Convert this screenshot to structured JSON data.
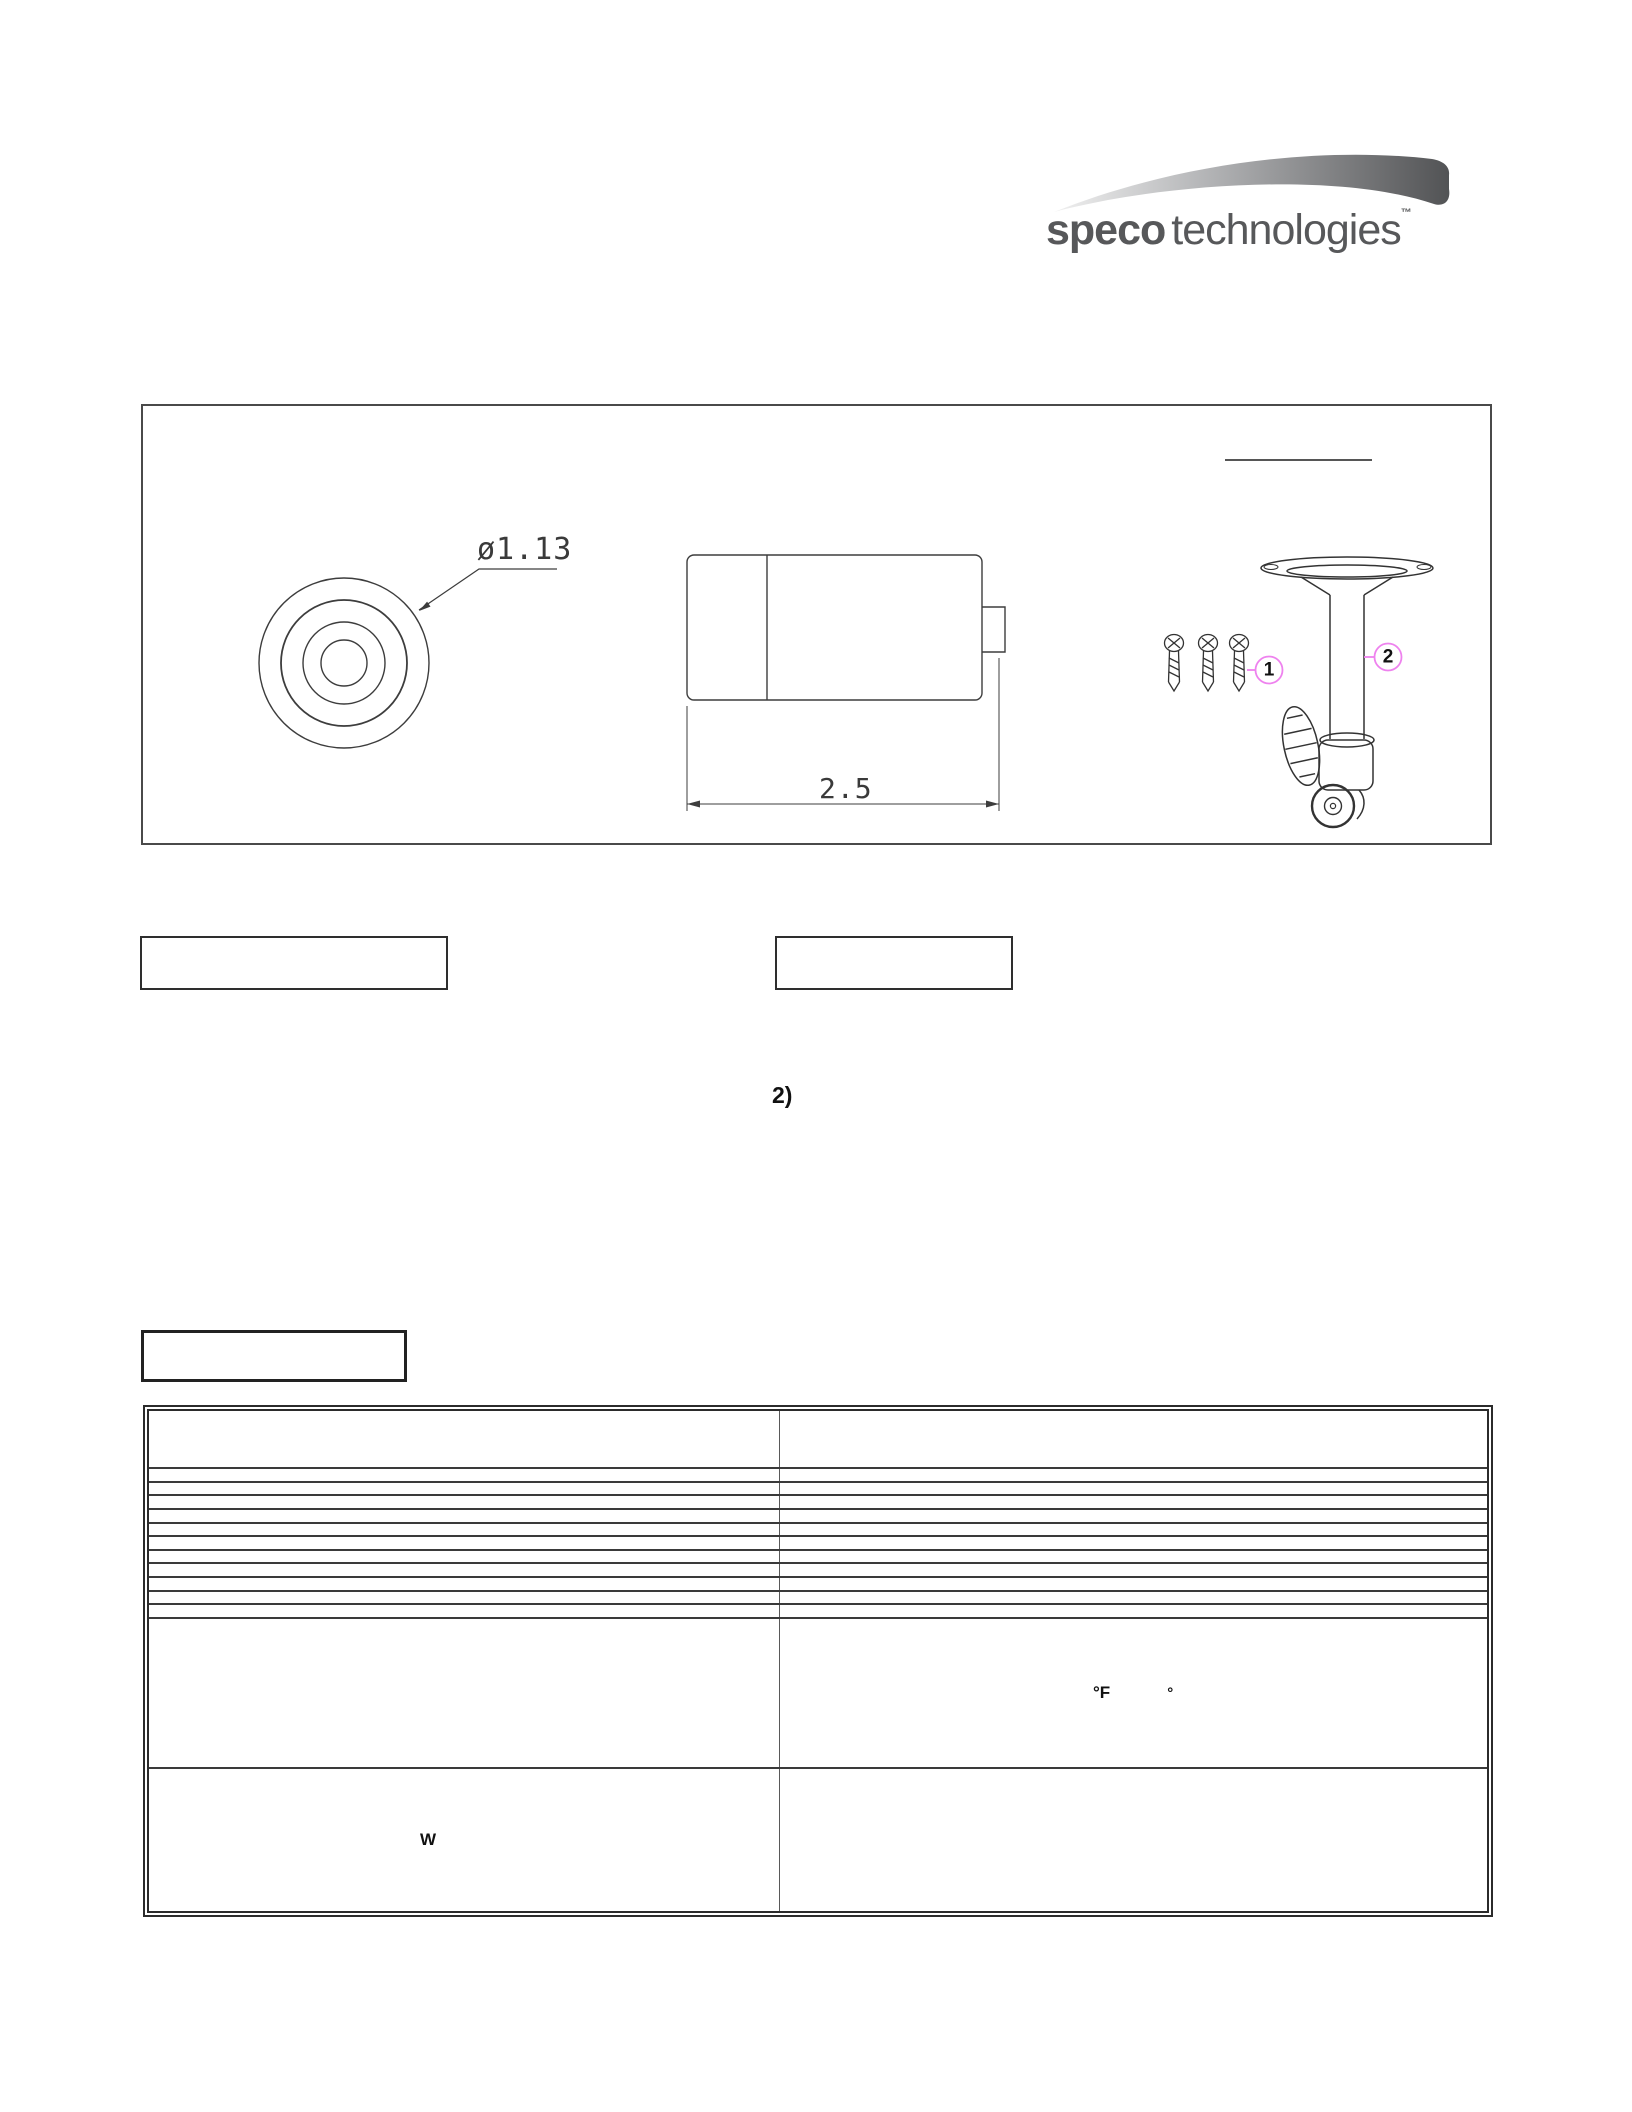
{
  "page": {
    "background": "#ffffff"
  },
  "logo": {
    "brand_bold": "speco",
    "brand_light": "technologies",
    "trademark": "™",
    "text_color": "#57585a"
  },
  "drawing_panel": {
    "front_view": {
      "diameter_label": "ø1.13"
    },
    "side_view": {
      "length_label": "2.5"
    },
    "callouts": [
      {
        "number": "1",
        "part": "mounting-screws"
      },
      {
        "number": "2",
        "part": "mounting-bracket"
      }
    ],
    "colors": {
      "callout_ring": "#ee82ee",
      "linework": "#3d3d3d"
    }
  },
  "step_label": "2)",
  "spec_table": {
    "columns": 2,
    "row_count": 14,
    "rows": [
      {
        "left": "",
        "right": ""
      },
      {
        "left": "",
        "right": ""
      },
      {
        "left": "",
        "right": ""
      },
      {
        "left": "",
        "right": ""
      },
      {
        "left": "",
        "right": ""
      },
      {
        "left": "",
        "right": ""
      },
      {
        "left": "",
        "right": ""
      },
      {
        "left": "",
        "right": ""
      },
      {
        "left": "",
        "right": ""
      },
      {
        "left": "",
        "right": ""
      },
      {
        "left": "",
        "right": ""
      },
      {
        "left": "",
        "right": ""
      },
      {
        "left": "",
        "right_fragments": {
          "unit_f": "°F",
          "degree": "°"
        }
      },
      {
        "left_fragment": "W",
        "right": ""
      }
    ]
  }
}
